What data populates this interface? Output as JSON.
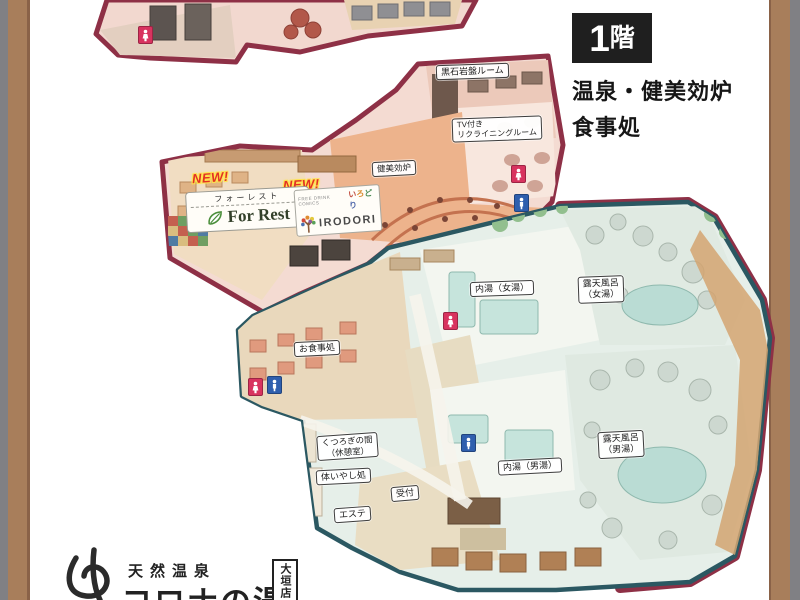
{
  "header": {
    "floor_number": "1",
    "floor_suffix": "階",
    "subtitle_line1": "温泉・健美効炉",
    "subtitle_line2": "食事処"
  },
  "map": {
    "chips": {
      "ganban_room": "黒石岩盤ルーム",
      "tv_recliner_line1": "TV付き",
      "tv_recliner_line2": "リクライニングルーム",
      "kenbikoro": "健美効炉",
      "naiyu_onna": "内湯（女湯）",
      "rotenburo_onna_line1": "露天風呂",
      "rotenburo_onna_line2": "（女湯）",
      "oshokujidokoro": "お食事処",
      "kutsurogi_line1": "くつろぎの間",
      "kutsurogi_line2": "（休憩室）",
      "iyashi": "体いやし処",
      "uketsuke": "受付",
      "esthe": "エステ",
      "naiyu_otoko": "内湯（男湯）",
      "rotenburo_otoko_line1": "露天風呂",
      "rotenburo_otoko_line2": "（男湯）"
    },
    "badges": {
      "new_left": "NEW!",
      "new_right": "NEW!"
    },
    "forrest": {
      "jp": "フォーレスト",
      "en": "For Rest"
    },
    "irodori": {
      "small": "FREE DRINK COMICS",
      "jp_chars": [
        "い",
        "ろ",
        "ど",
        "り"
      ],
      "en": "IRODORI"
    }
  },
  "logo": {
    "line_top": "天然温泉",
    "line_main": "コロナの湯",
    "branch": "大垣店"
  },
  "icons": {
    "womens_restroom_icon": "white person on pink square",
    "mens_restroom_icon": "white person on blue square",
    "leaf_icon": "green leaf (For Rest)",
    "tree_icon": "colorful tree (IRODORI)",
    "yu_mark_icon": "brush-style hiragana yu logo mark"
  },
  "colors": {
    "outline_maroon": "#8e3046",
    "outline_teal": "#2b5862",
    "area_pink": "#f4dbd2",
    "bath_fill": "#e6efe9",
    "frame_brown": "#a87e5b",
    "frame_gray": "#808084",
    "new_red": "#e33124",
    "new_yellow": "#ffe34d",
    "restroom_pink": "#d8335f",
    "restroom_blue": "#2f5fae",
    "badge_black": "#1f1f1f"
  }
}
